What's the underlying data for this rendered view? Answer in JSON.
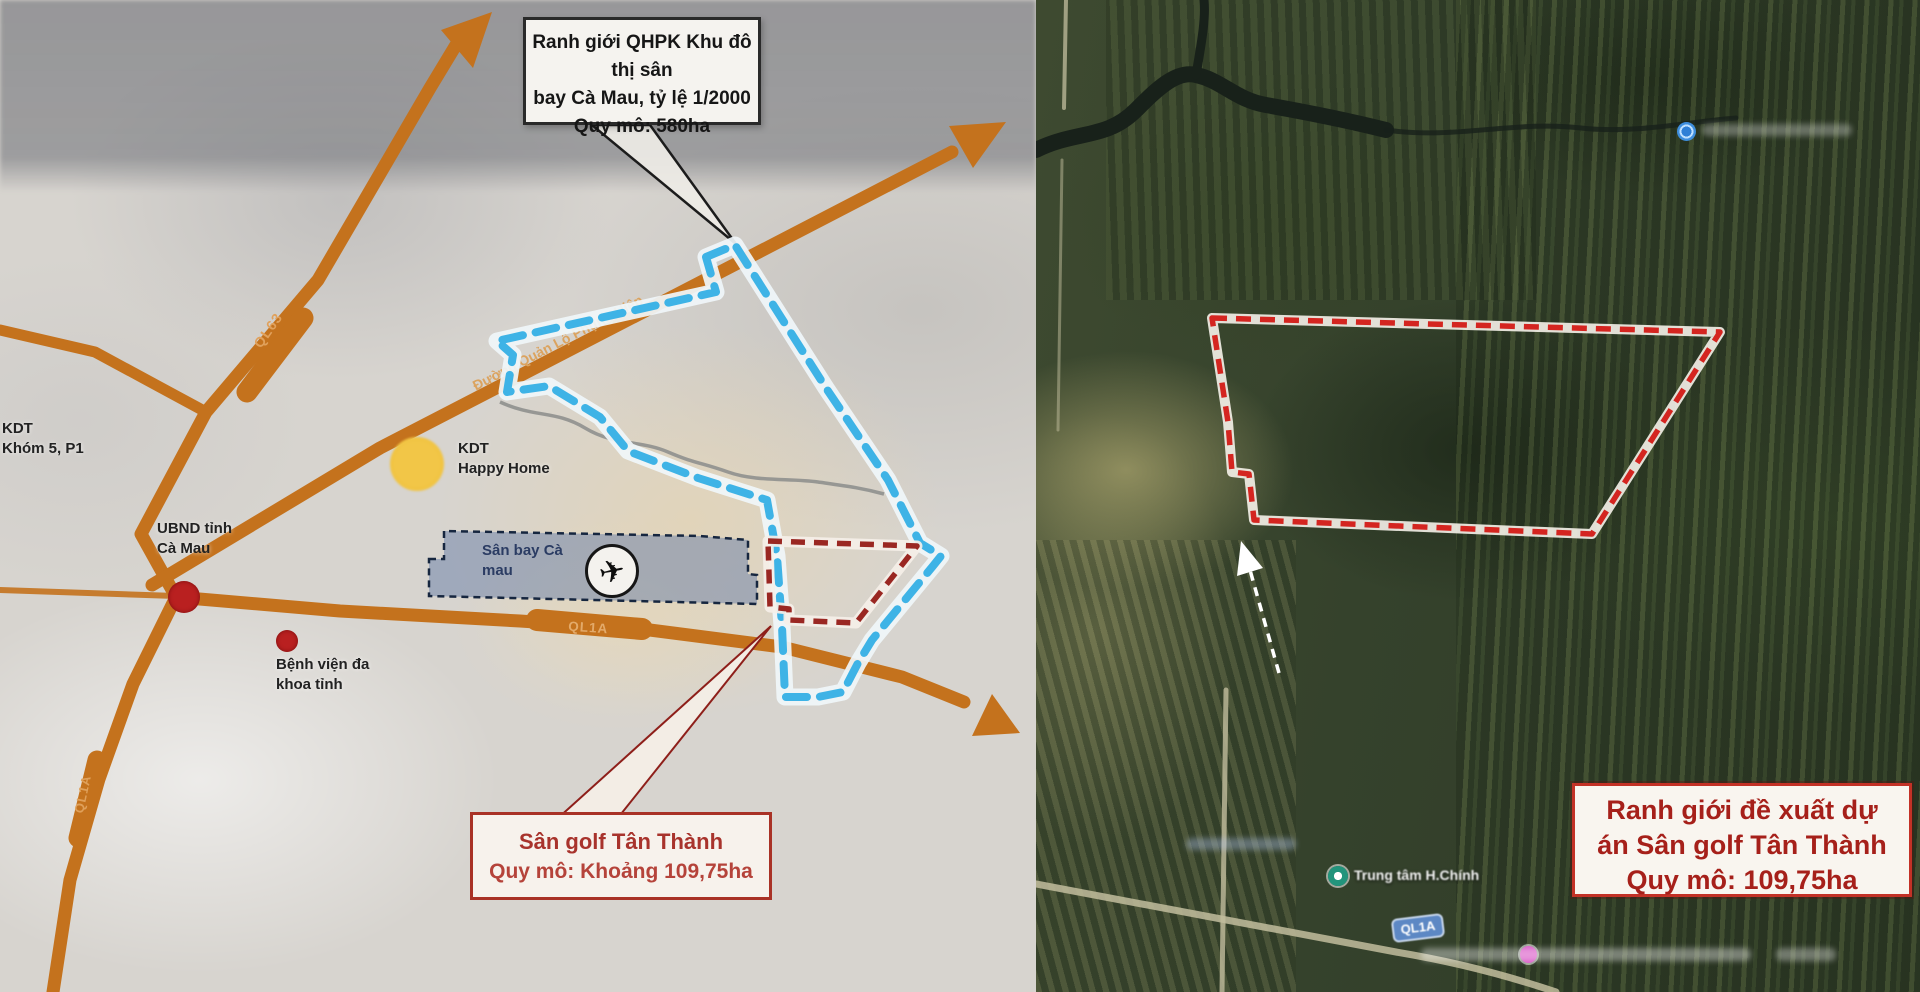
{
  "left_map": {
    "qhpk_callout": {
      "line1": "Ranh giới QHPK Khu đô thị sân",
      "line2": "bay Cà Mau, tỷ lệ 1/2000",
      "line3": "Quy mô: 580ha"
    },
    "golf_callout": {
      "line1": "Sân golf Tân Thành",
      "line2": "Quy mô: Khoảng 109,75ha"
    },
    "airport_label": {
      "line1": "Sân bay Cà",
      "line2": "mau"
    },
    "poi": {
      "kdt_khom5": {
        "line1": "KDT",
        "line2": "Khóm 5, P1"
      },
      "ubnd": {
        "line1": "UBND tỉnh",
        "line2": "Cà Mau"
      },
      "kdt_happy_home": {
        "line1": "KDT",
        "line2": "Happy Home"
      },
      "benh_vien": {
        "line1": "Bệnh viện đa",
        "line2": "khoa tỉnh"
      }
    },
    "roads": {
      "ql63": "QL63",
      "phung_hiep": "Đường Quản Lộ Phụng Hiệp",
      "ql1a_east": "QL1A",
      "ql1a_south": "QL1A"
    },
    "airplane_icon": "✈"
  },
  "right_map": {
    "proposal_callout": {
      "line1": "Ranh giới đề xuất dự",
      "line2": "án Sân golf Tân Thành",
      "line3": "Quy mô: 109,75ha"
    },
    "ql1a_shield": "QL1A",
    "poi_trung_tam": "Trung tâm H.Chính"
  },
  "colors": {
    "road_orange": "#c4721d",
    "road_label": "#e0a15c",
    "blue_boundary": "#3eb3e6",
    "red_boundary_left": "#9a2722",
    "red_boundary_right": "#d42520",
    "airport_fill": "rgba(104,126,168,0.5)",
    "airport_border": "#16263f",
    "marker_red": "#b92020",
    "marker_yellow": "#f0c23e",
    "marker_green": "#22947c",
    "marker_pink": "#d959c6",
    "marker_blue": "#3e8edd",
    "shield_blue": "#5d88c4",
    "canal_dark": "#18211a"
  }
}
